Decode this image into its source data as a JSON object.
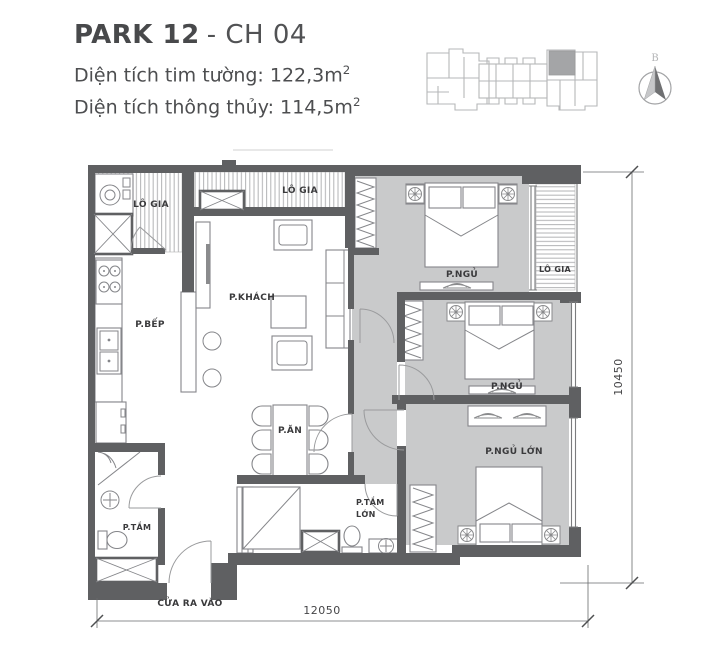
{
  "header": {
    "title_bold": "PARK 12",
    "title_rest": "- CH 04",
    "area_lines": [
      {
        "text": "Diện tích tim tường: 122,3m",
        "sup": "2"
      },
      {
        "text": "Diện tích thông thủy: 114,5m",
        "sup": "2"
      }
    ]
  },
  "compass": {
    "label": "B"
  },
  "rooms": {
    "lo_gia_left": "LÔ GIA",
    "lo_gia_center": "LÔ GIA",
    "lo_gia_right": "LÔ GIA",
    "living": "P.KHÁCH",
    "kitchen": "P.BẾP",
    "bedroom_1": "P.NGỦ",
    "bedroom_2": "P.NGỦ",
    "master_bedroom": "P.NGỦ LỚN",
    "dining": "P.ĂN",
    "bathroom": "P.TẮM",
    "master_bathroom_line1": "P.TẮM",
    "master_bathroom_line2": "LỚN",
    "entrance": "CỬA RA VÀO"
  },
  "dimensions": {
    "bottom": "12050",
    "right": "10450"
  },
  "colors": {
    "wall": "#5f6062",
    "floor": "#c9cacb",
    "hatch": "#b2b3b5",
    "furniture_line": "#85868a",
    "label_text": "#3a3a3c",
    "title_text": "#48494b",
    "keyplan_line": "#b6b7b9",
    "keyplan_highlight": "#a4a5a7"
  }
}
